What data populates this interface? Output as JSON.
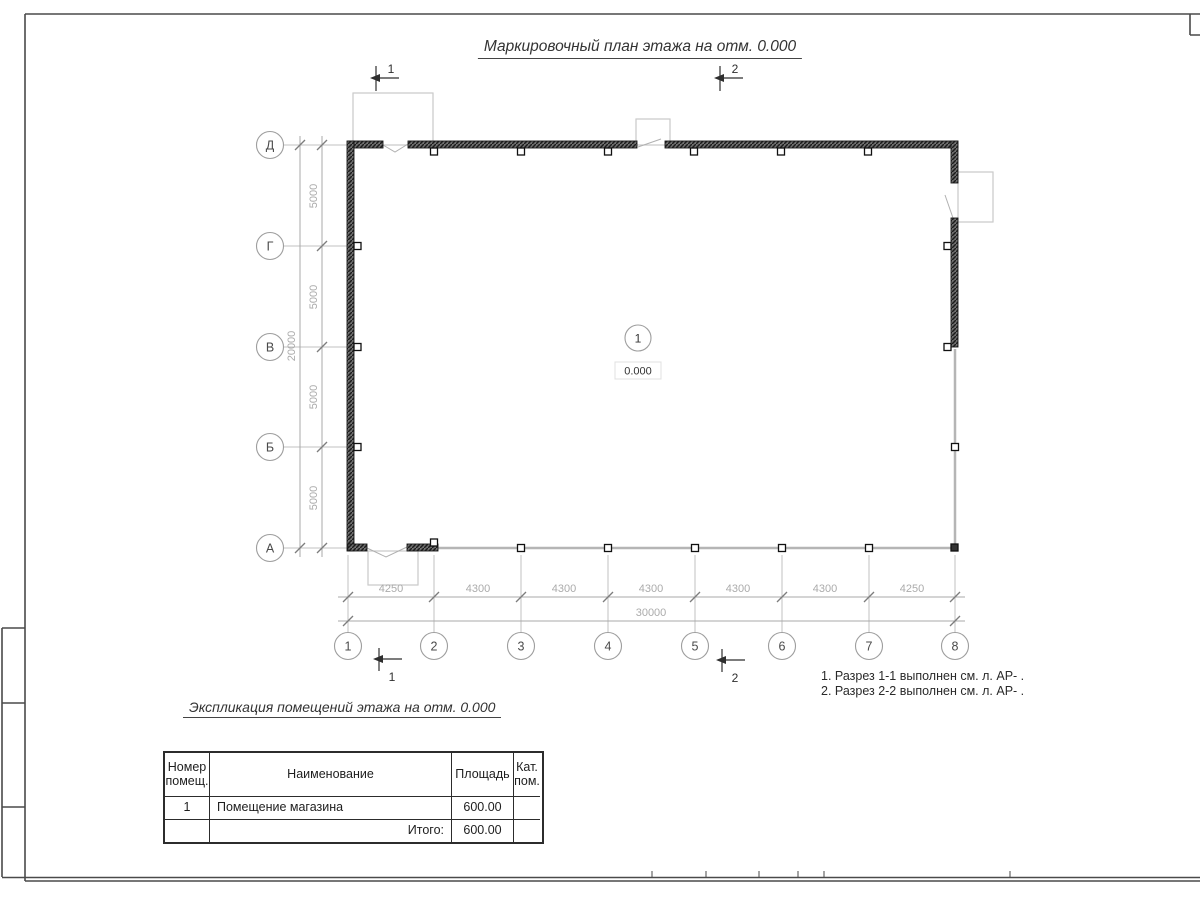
{
  "titles": {
    "plan_title": "Маркировочный план этажа на отм. 0.000",
    "table_title": "Экспликация помещений этажа на отм. 0.000"
  },
  "notes": {
    "line1": "1. Разрез 1-1 выполнен см. л. АР- .",
    "line2": "2. Разрез 2-2 выполнен см. л. АР- ."
  },
  "plan": {
    "row_axes": [
      "Д",
      "Г",
      "В",
      "Б",
      "А"
    ],
    "col_axes": [
      "1",
      "2",
      "3",
      "4",
      "5",
      "6",
      "7",
      "8"
    ],
    "v_dims": [
      "5000",
      "5000",
      "5000",
      "5000"
    ],
    "v_total": "20000",
    "h_dims": [
      "4250",
      "4300",
      "4300",
      "4300",
      "4300",
      "4300",
      "4250"
    ],
    "h_total": "30000",
    "section1": "1",
    "section2": "2",
    "room_number": "1",
    "room_elevation": "0.000"
  },
  "table": {
    "col_num": "Номер помещ.",
    "col_name": "Наименование",
    "col_area": "Площадь",
    "col_cat": "Кат. пом.",
    "row1_num": "1",
    "row1_name": "Помещение магазина",
    "row1_area": "600.00",
    "row1_cat": "",
    "total_label": "Итого:",
    "total_area": "600.00"
  },
  "colors": {
    "wall": "#2a2a2a",
    "thin_wall": "#b5b5b5",
    "dim_text": "#a9a9a9",
    "ink": "#222222"
  }
}
